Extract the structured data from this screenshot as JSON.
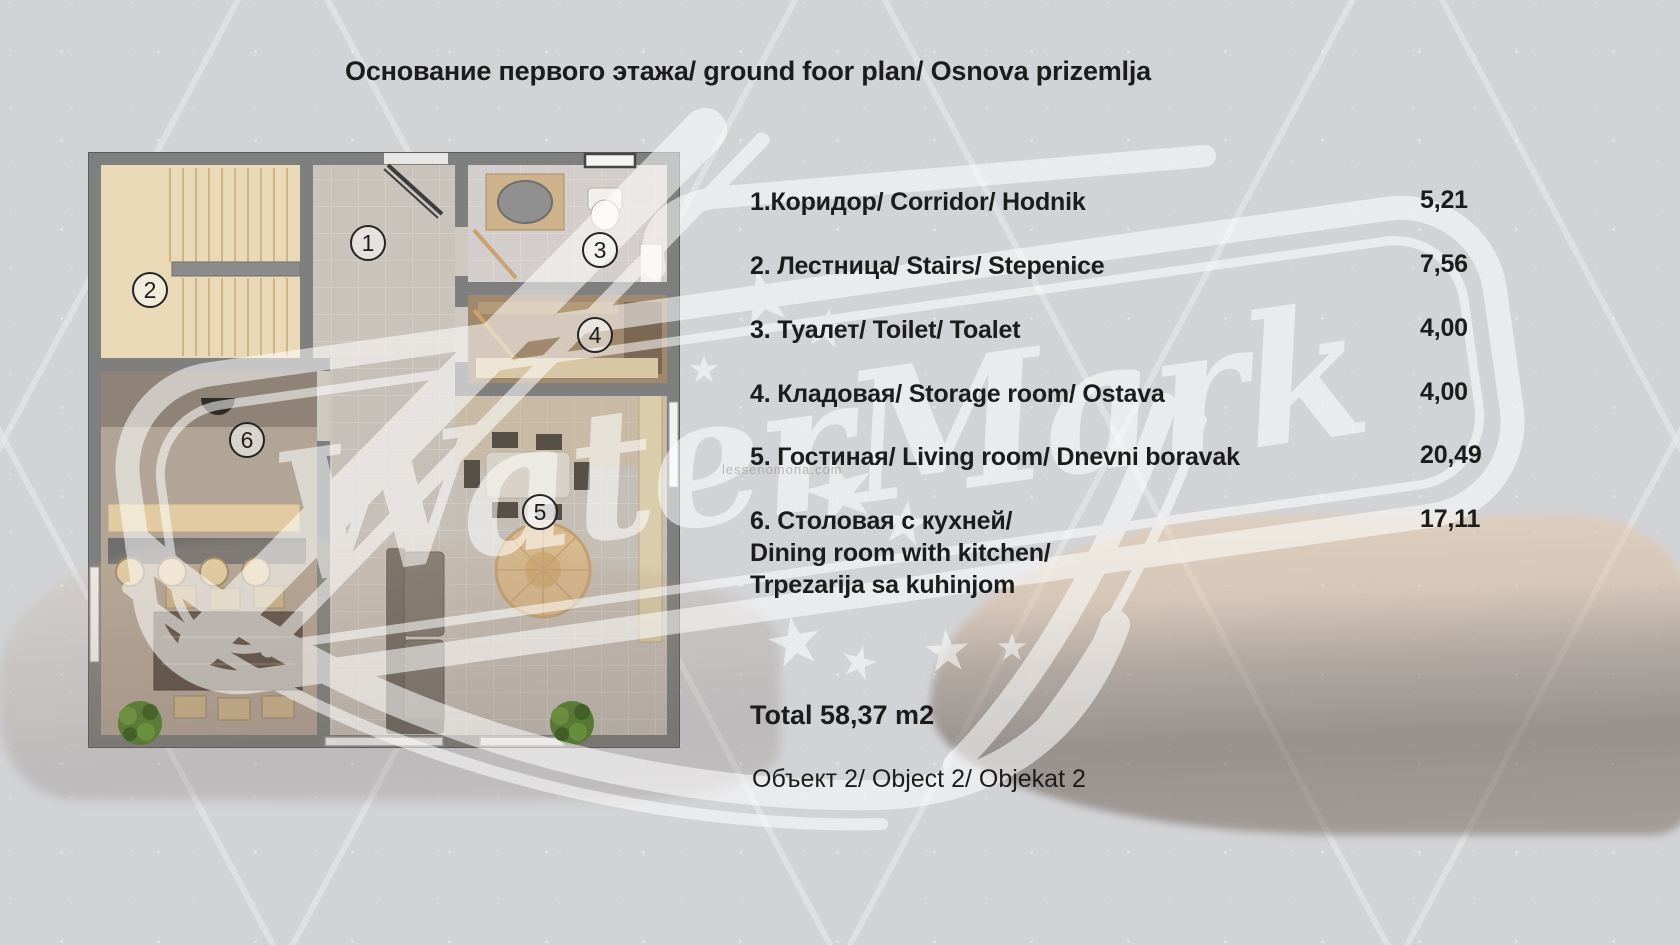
{
  "title": "Основание первого этажа/ ground foor plan/ Osnova prizemlja",
  "legend": {
    "rows": [
      {
        "lines": [
          "1.Коридор/ Corridor/ Hodnik"
        ],
        "area": "5,21"
      },
      {
        "lines": [
          "2. Лестница/ Stairs/ Stepenice"
        ],
        "area": "7,56"
      },
      {
        "lines": [
          "3. Туалет/ Toilet/ Toalet"
        ],
        "area": "4,00"
      },
      {
        "lines": [
          "4. Кладовая/ Storage room/ Ostava"
        ],
        "area": "4,00"
      },
      {
        "lines": [
          "5. Гостиная/ Living room/ Dnevni boravak"
        ],
        "area": "20,49"
      },
      {
        "lines": [
          "6. Столовая с кухней/",
          "Dining room with kitchen/",
          "Trpezarija sa kuhinjom"
        ],
        "area": "17,11"
      }
    ],
    "total": "Total 58,37 m2",
    "object_line": "Объект 2/ Object 2/ Objekat 2"
  },
  "plan": {
    "numbers": [
      "1",
      "2",
      "3",
      "4",
      "5",
      "6"
    ]
  },
  "watermark": {
    "text": "WaterMark",
    "url_text": "lessenomona.com"
  },
  "colors": {
    "background": "#d2d3d6",
    "text": "#1c1c1c",
    "wall_gray": "#7f7f7f",
    "stairs_beige": "#ead9b6",
    "storage_brown": "#a0886c",
    "watermark_white": "#ffffff"
  }
}
